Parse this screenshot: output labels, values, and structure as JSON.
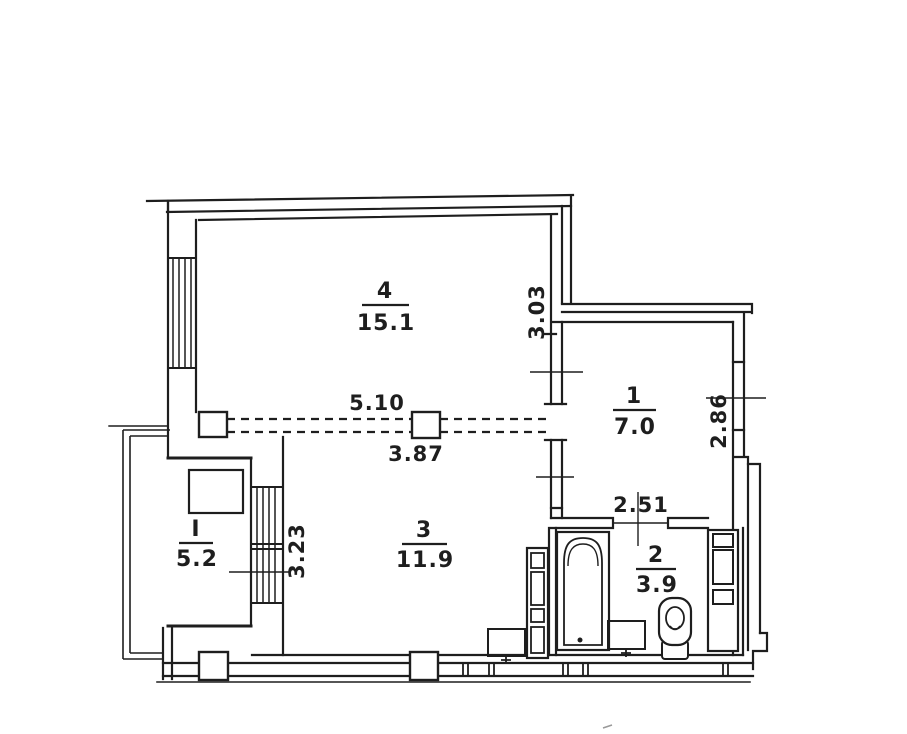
{
  "plan": {
    "rooms": [
      {
        "number": "4",
        "area": "15.1"
      },
      {
        "number": "1",
        "area": "7.0"
      },
      {
        "number": "2",
        "area": "3.9"
      },
      {
        "number": "3",
        "area": "11.9"
      },
      {
        "number": "I",
        "area": "5.2"
      }
    ],
    "dimensions": {
      "room4_width": "5.10",
      "room3_top_width": "3.87",
      "room4_side": "3.03",
      "room1_side": "2.86",
      "bathroom_top_width": "2.51",
      "room3_side": "3.23"
    },
    "colors": {
      "ink": "#1e1e1e",
      "paper": "#ffffff"
    }
  }
}
